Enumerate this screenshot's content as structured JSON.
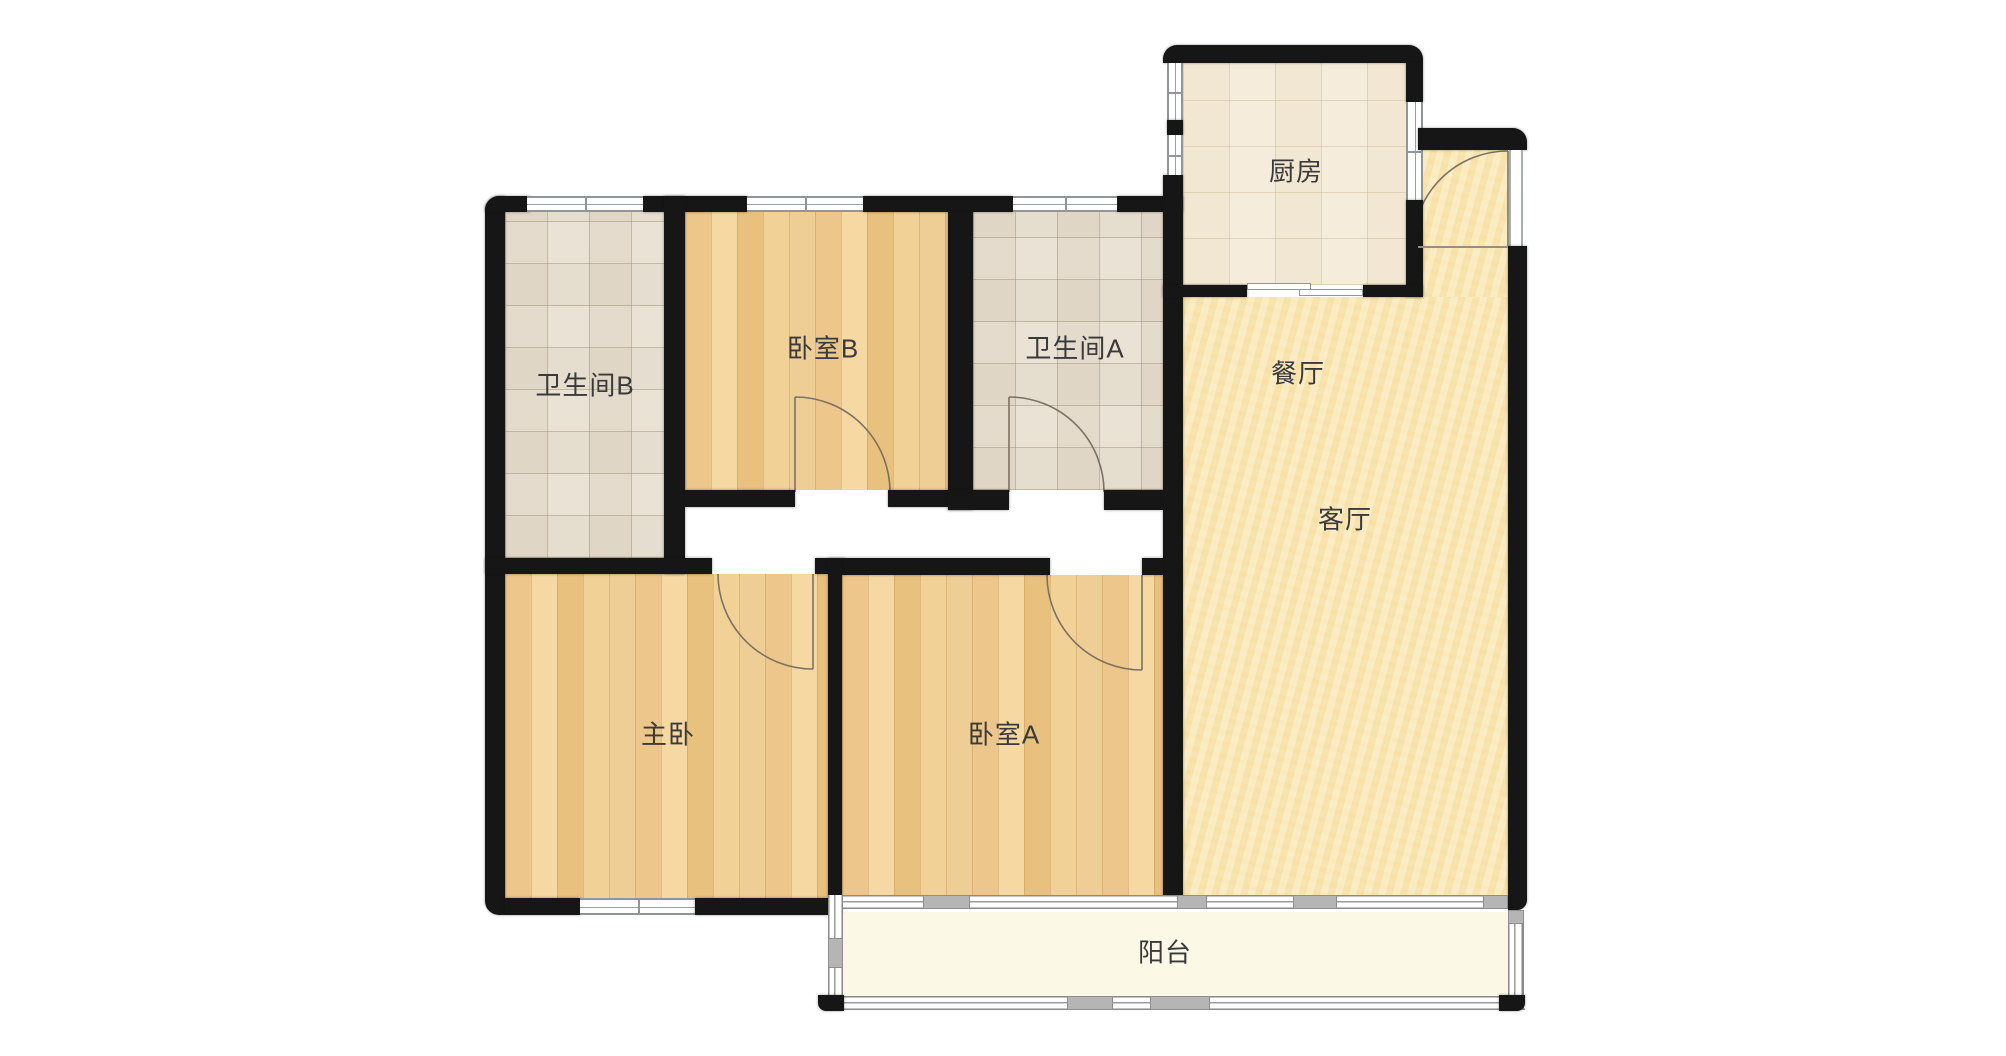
{
  "floorplan": {
    "type": "apartment-floor-plan",
    "rooms": [
      {
        "id": "kitchen",
        "label": "厨房"
      },
      {
        "id": "dining-room",
        "label": "餐厅"
      },
      {
        "id": "living-room",
        "label": "客厅"
      },
      {
        "id": "bathroom-b",
        "label": "卫生间B"
      },
      {
        "id": "bedroom-b",
        "label": "卧室B"
      },
      {
        "id": "bathroom-a",
        "label": "卫生间A"
      },
      {
        "id": "master-bedroom",
        "label": "主卧"
      },
      {
        "id": "bedroom-a",
        "label": "卧室A"
      },
      {
        "id": "balcony",
        "label": "阳台"
      }
    ],
    "colors": {
      "wall": "#161616",
      "wood_floor": "#eecb92",
      "bathroom_tile": "#e8e1d5",
      "kitchen_tile": "#f4ebda",
      "hall_floor": "#f9e9bc",
      "balcony_floor": "#fbf8e6",
      "door_arc": "#7b7264",
      "window_line": "#8f9598"
    }
  }
}
